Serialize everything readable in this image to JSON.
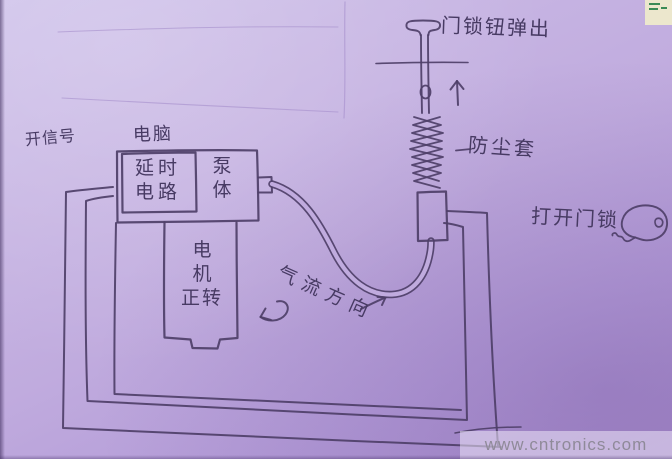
{
  "labels": {
    "lock_button_pop": "门锁钮弹出",
    "dust_cover": "防尘套",
    "open_lock": "打开门锁",
    "open_signal": "开信号",
    "computer": "电脑",
    "delay_circuit_line1": "延时",
    "delay_circuit_line2": "电路",
    "pump_body_char1": "泵",
    "pump_body_char2": "体",
    "motor_char1": "电",
    "motor_char2": "机",
    "motor_forward": "正转",
    "airflow_direction": "气流方向"
  },
  "watermark": {
    "text": "www.cntronics.com"
  },
  "icons": {
    "key": "key-icon",
    "up_arrow": "up-arrow-icon",
    "rotation_arrow": "rotation-arrow-icon",
    "airflow_arrow": "airflow-arrow-icon"
  },
  "colors": {
    "paper_light": "#cec1ea",
    "paper_mid": "#c0abde",
    "paper_dark": "#a88dcc",
    "ink": "#4e3f68",
    "watermark_text": "#8f8a99",
    "watermark_bg": "rgba(236,229,248,0.55)",
    "corner_fragment_bg": "#ece7cd",
    "corner_fragment_mark": "#3a8a55"
  }
}
